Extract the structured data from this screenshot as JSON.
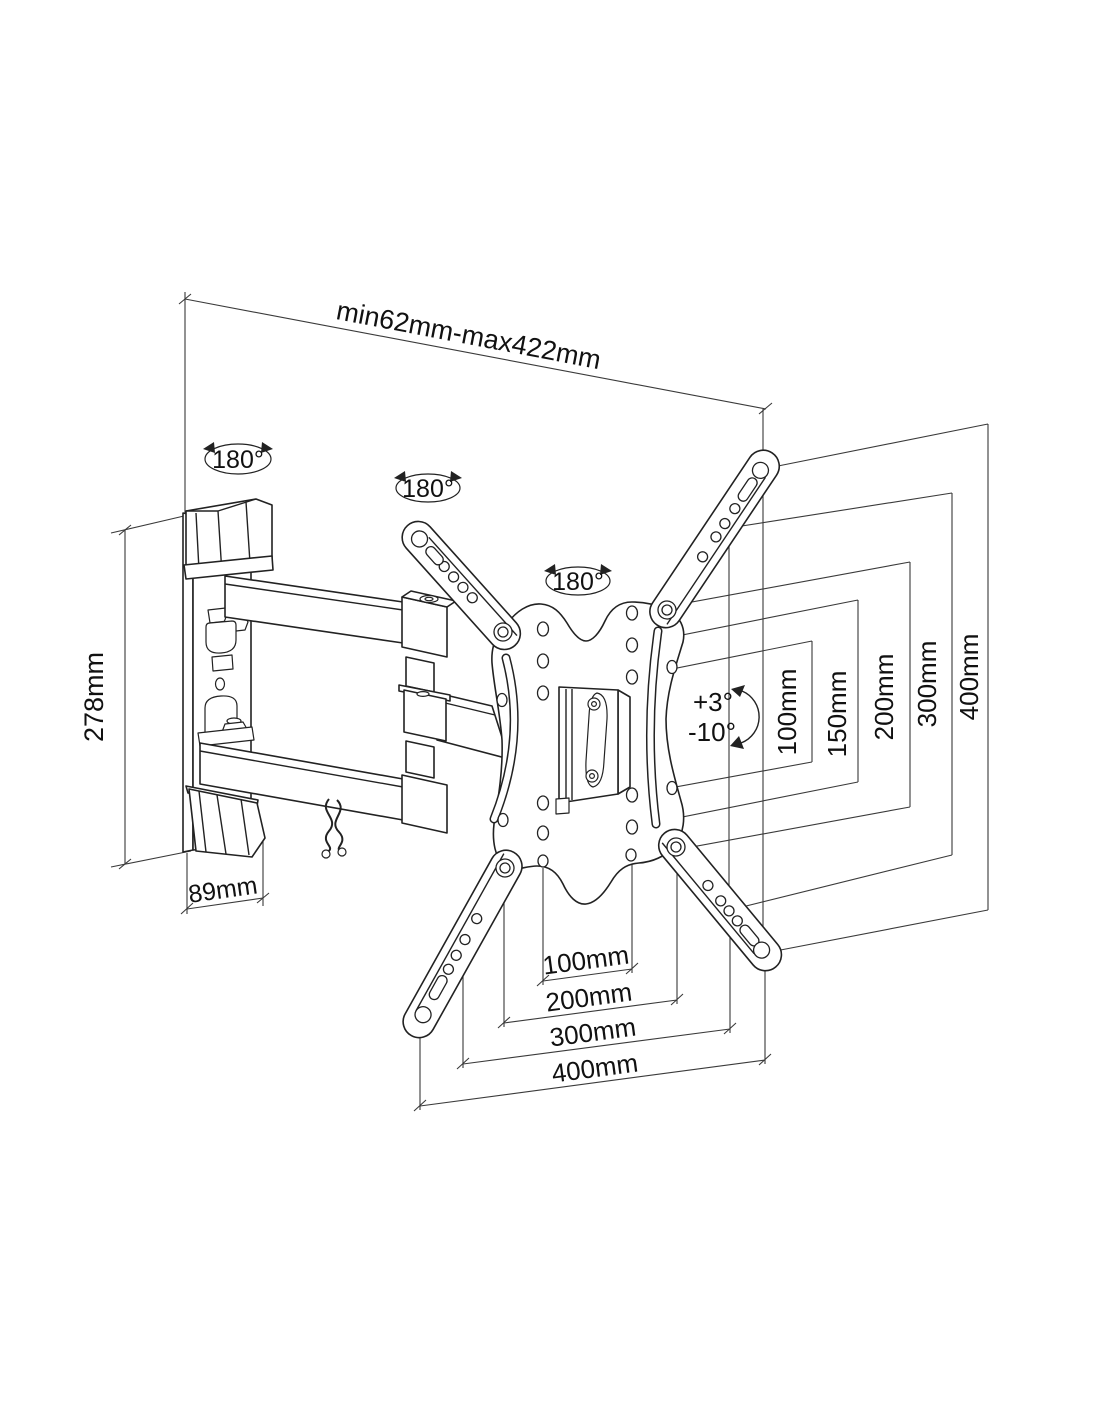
{
  "title": "TV wall mount technical drawing",
  "colors": {
    "line": "#222222",
    "dimension_line": "#3a3a3a",
    "text": "#111111",
    "background": "#ffffff"
  },
  "labels": {
    "extension_range": "min62mm-max422mm",
    "bracket_height": "278mm",
    "bracket_depth": "89mm",
    "tilt_up": "+3°",
    "tilt_down": "-10°"
  },
  "rotation_labels": [
    "180°",
    "180°",
    "180°"
  ],
  "vesa_vertical": [
    "100mm",
    "150mm",
    "200mm",
    "300mm",
    "400mm"
  ],
  "vesa_horizontal": [
    "100mm",
    "200mm",
    "300mm",
    "400mm"
  ]
}
